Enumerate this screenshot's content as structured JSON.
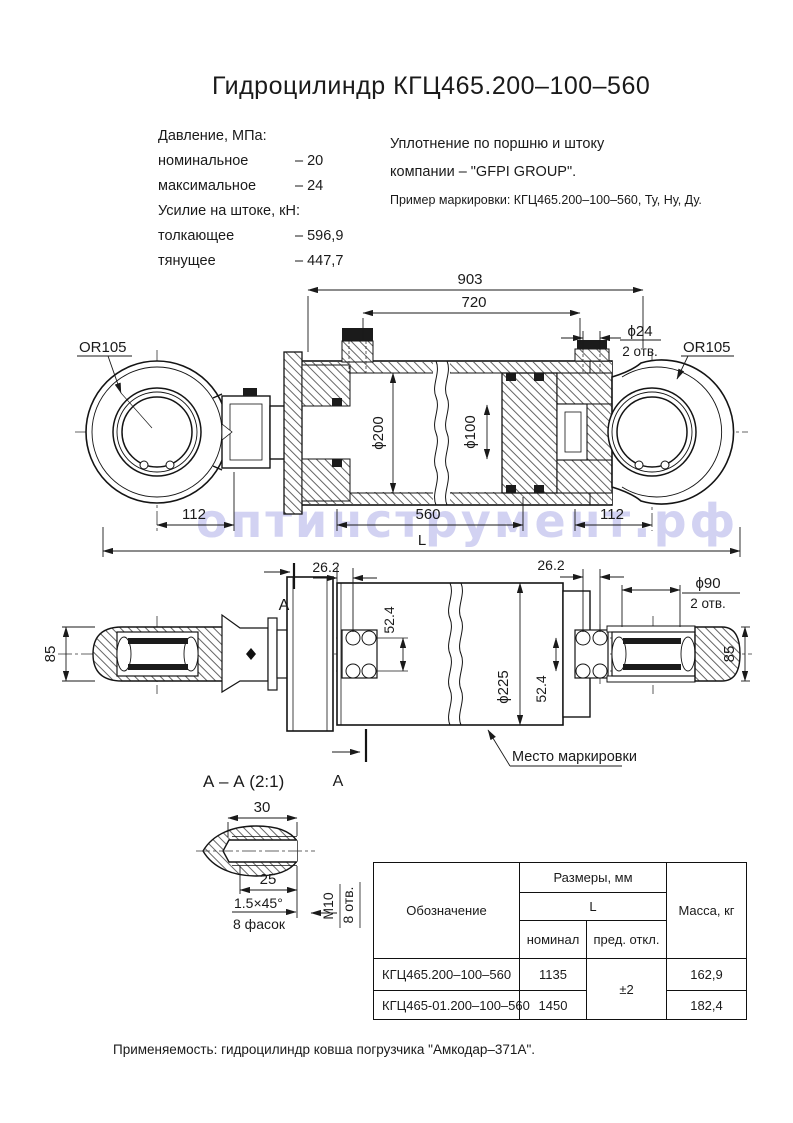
{
  "title": "Гидроцилиндр КГЦ465.200–100–560",
  "watermark": "оптинструмент.рф",
  "specs": {
    "pressure_header": "Давление, МПа:",
    "nominal_label": "номинальное",
    "nominal_value": "– 20",
    "max_label": "максимальное",
    "max_value": "– 24",
    "force_header": "Усилие на штоке, кН:",
    "push_label": "толкающее",
    "push_value": "– 596,9",
    "pull_label": "тянущее",
    "pull_value": "– 447,7"
  },
  "notes": {
    "seal_line1": "Уплотнение по поршню и штоку",
    "seal_line2": "компании – \"GFPI GROUP\".",
    "marking_example": "Пример маркировки: КГЦ465.200–100–560, Ту, Ну, Ду."
  },
  "main_view": {
    "dim_overall": "903",
    "dim_span": "720",
    "dim_port_dia": "ϕ24",
    "dim_port_qty": "2 отв.",
    "eye_label": "OR105",
    "dim_bore": "ϕ200",
    "dim_rod": "ϕ100",
    "dim_left": "112",
    "dim_stroke": "560",
    "dim_length": "L",
    "dim_right": "112"
  },
  "side_view": {
    "dim_hole_offset": "26.2",
    "dim_eye_hole_dia": "ϕ90",
    "dim_eye_hole_qty": "2 отв.",
    "dim_eye_width": "85",
    "dim_hole_spacing": "52.4",
    "dim_body_dia": "ϕ225",
    "marking_note": "Место маркировки"
  },
  "section": {
    "title": "А – А (2:1)",
    "cut_label": "А",
    "dim_width": "30",
    "dim_depth": "25",
    "chamfer": "1.5×45°",
    "chamfer_qty": "8 фасок",
    "thread": "М10",
    "holes_qty": "8 отв."
  },
  "table": {
    "col_designation": "Обозначение",
    "col_sizes": "Размеры, мм",
    "col_l": "L",
    "col_nominal": "номинал",
    "col_deviation": "пред. откл.",
    "col_mass": "Масса, кг",
    "deviation": "±2",
    "rows": [
      {
        "designation": "КГЦ465.200–100–560",
        "nominal": "1135",
        "mass": "162,9"
      },
      {
        "designation": "КГЦ465-01.200–100–560",
        "nominal": "1450",
        "mass": "182,4"
      }
    ]
  },
  "footer": {
    "application": "Применяемость:  гидроцилиндр ковша погрузчика \"Амкодар–371А\"."
  }
}
